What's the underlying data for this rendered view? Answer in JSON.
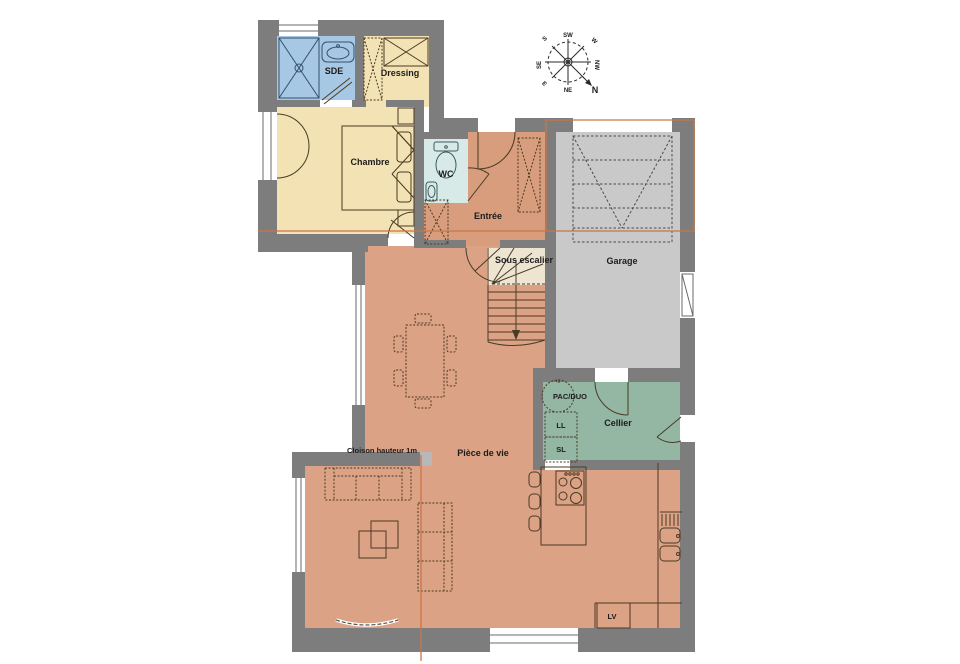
{
  "rooms": {
    "sde": {
      "label": "SDE",
      "color": "#a6c8e4"
    },
    "dressing": {
      "label": "Dressing",
      "color": "#f2e2b4"
    },
    "chambre": {
      "label": "Chambre",
      "color": "#f2e2b4"
    },
    "wc": {
      "label": "WC",
      "color": "#d8eae8"
    },
    "entree": {
      "label": "Entrée",
      "color": "#d89d7d"
    },
    "garage": {
      "label": "Garage",
      "color": "#c9c9c9"
    },
    "sous_escalier": {
      "label": "Sous escalier",
      "color": "#ede5d2"
    },
    "cellier": {
      "label": "Cellier",
      "color": "#93b7a3"
    },
    "piece_de_vie": {
      "label": "Pièce de vie",
      "color": "#dca285"
    }
  },
  "annotations": {
    "cloison": "Cloison hauteur 1m",
    "pac": "PAC/DUO",
    "ll": "LL",
    "sl": "SL",
    "lv": "LV"
  },
  "compass": {
    "n": "N",
    "ne": "NE",
    "e": "E",
    "se": "SE",
    "s": "S",
    "sw": "SW",
    "w": "W",
    "nw": "NW"
  },
  "colors": {
    "wall": "#7d7d7d",
    "window": "#ffffff",
    "section_line": "#c9764a",
    "furniture_stroke": "#4a3b25",
    "cloison_cap": "#b8b8b8"
  }
}
